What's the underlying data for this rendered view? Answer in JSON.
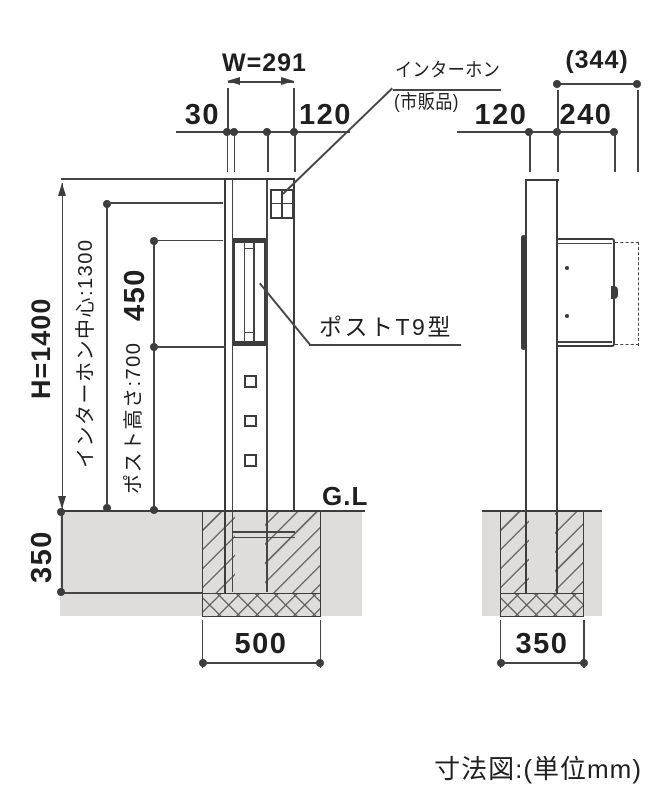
{
  "caption": "寸法図:(単位mm)",
  "colors": {
    "line": "#454545",
    "text": "#1f1f1f",
    "ground_fill": "#dfdddc"
  },
  "front": {
    "width_label": "W=291",
    "offset_left": "30",
    "offset_right": "120",
    "height_label": "H=1400",
    "intercom_center": "インターホン中心:1300",
    "dim_450": "450",
    "post_height": "ポスト高さ:700",
    "embed_depth": "350",
    "foundation_width": "500",
    "ground_label": "G.L"
  },
  "side": {
    "total_depth": "(344)",
    "offset_front": "120",
    "depth_240": "240",
    "foundation_width": "350"
  },
  "callouts": {
    "intercom": "インターホン",
    "intercom_note": "(市販品)",
    "post_model": "ポストT9型"
  }
}
